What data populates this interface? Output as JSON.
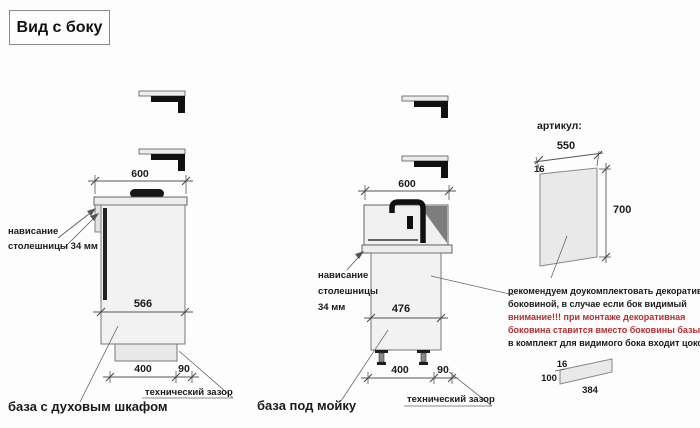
{
  "title": "Вид с боку",
  "colors": {
    "line": "#555555",
    "body_fill": "#f2f2f2",
    "slab_fill": "#ededed",
    "dark": "#1a1a1a",
    "sink_shadow": "#7d7d7d",
    "warning_red": "#b32d2d"
  },
  "cabinet_oven": {
    "name": "база с духовым шкафом",
    "countertop_width": "600",
    "body_depth": "566",
    "plinth_depth": "400",
    "rear_gap": "90",
    "overhang_note": [
      "нависание",
      "столешницы 34 мм"
    ],
    "gap_note": "технический зазор"
  },
  "cabinet_sink": {
    "name": "база под мойку",
    "countertop_width": "600",
    "body_depth": "476",
    "plinth_depth": "400",
    "rear_gap": "90",
    "overhang_note": [
      "нависание",
      "столешницы",
      "34 мм"
    ],
    "gap_note": "технический зазор"
  },
  "decor_panel": {
    "heading": "артикул:",
    "width": "550",
    "thickness": "16",
    "height": "700",
    "note_black_1": "рекомендуем доукомплектовать декоративной",
    "note_black_2": "боковиной, в случае если бок видимый",
    "warning_1": "внимание!!! при монтаже декоративная",
    "warning_2": "боковина ставится вместо боковины базы лдсп",
    "note_black_3": "в комплект для видимого бока входит цоколь:"
  },
  "plinth_panel": {
    "thickness": "16",
    "height": "100",
    "length": "384"
  }
}
